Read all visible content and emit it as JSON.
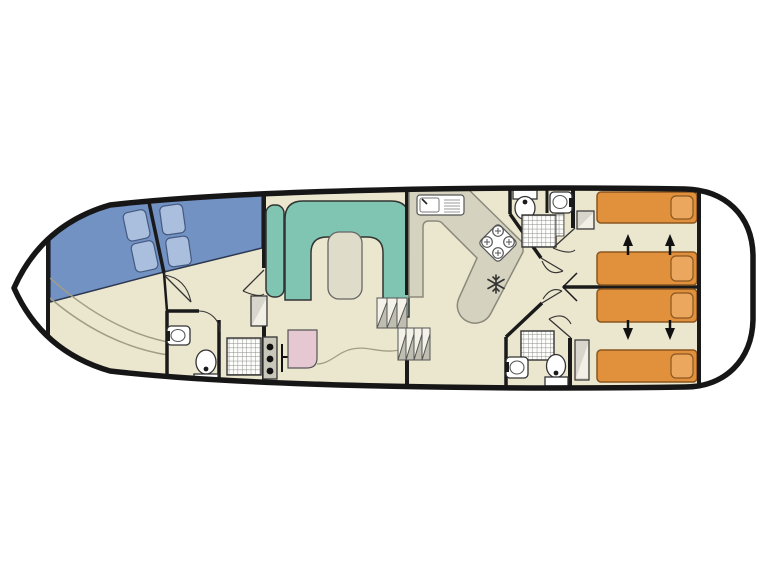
{
  "page": {
    "background": "#ffffff"
  },
  "floorplan": {
    "type": "canal-boat-deck-plan",
    "orientation": "bow-left-stern-right",
    "colors": {
      "hull": "#161616",
      "deck": "#ffffff",
      "floor": "#ebe6ce",
      "wall": "#1a1a1a",
      "bow_bed": "#7292c4",
      "bow_pillow": "#aabedd",
      "sofa": "#7fc5b2",
      "table": "#dfddc9",
      "worktop": "#d5d3c0",
      "worktop_pink": "#e6c8d2",
      "stern_bed": "#e1903c",
      "stern_pillow": "#eca75f",
      "wardrobe": "#d8d6cc",
      "fixture_fill": "#ffffff",
      "grid_line": "#8a8a85",
      "bench_line": "#a29d85"
    },
    "sections": [
      {
        "name": "bow-deck",
        "fixtures": []
      },
      {
        "name": "bow-cabin",
        "fixtures": [
          "angled-double-bed",
          "angled-double-bed",
          "curved-bench"
        ]
      },
      {
        "name": "bow-bathroom",
        "fixtures": [
          "washbasin",
          "toilet",
          "shower"
        ]
      },
      {
        "name": "saloon",
        "fixtures": [
          "u-shaped-sofa",
          "side-seat",
          "table",
          "wardrobe"
        ]
      },
      {
        "name": "galley",
        "fixtures": [
          "sink-drainer",
          "worktop",
          "hob-4-burner",
          "fridge",
          "cooker",
          "pink-worktop",
          "steps"
        ]
      },
      {
        "name": "bathroom-top",
        "fixtures": [
          "toilet",
          "washbasin",
          "shower",
          "towel-ladder"
        ]
      },
      {
        "name": "bathroom-bottom",
        "fixtures": [
          "shower",
          "washbasin",
          "toilet"
        ]
      },
      {
        "name": "stern-cabin-top",
        "fixtures": [
          "single-bed",
          "single-bed",
          "wardrobe",
          "slide-together-arrows"
        ]
      },
      {
        "name": "stern-cabin-bottom",
        "fixtures": [
          "single-bed",
          "single-bed",
          "wardrobe",
          "slide-together-arrows"
        ]
      },
      {
        "name": "stern-deck",
        "fixtures": []
      }
    ]
  }
}
